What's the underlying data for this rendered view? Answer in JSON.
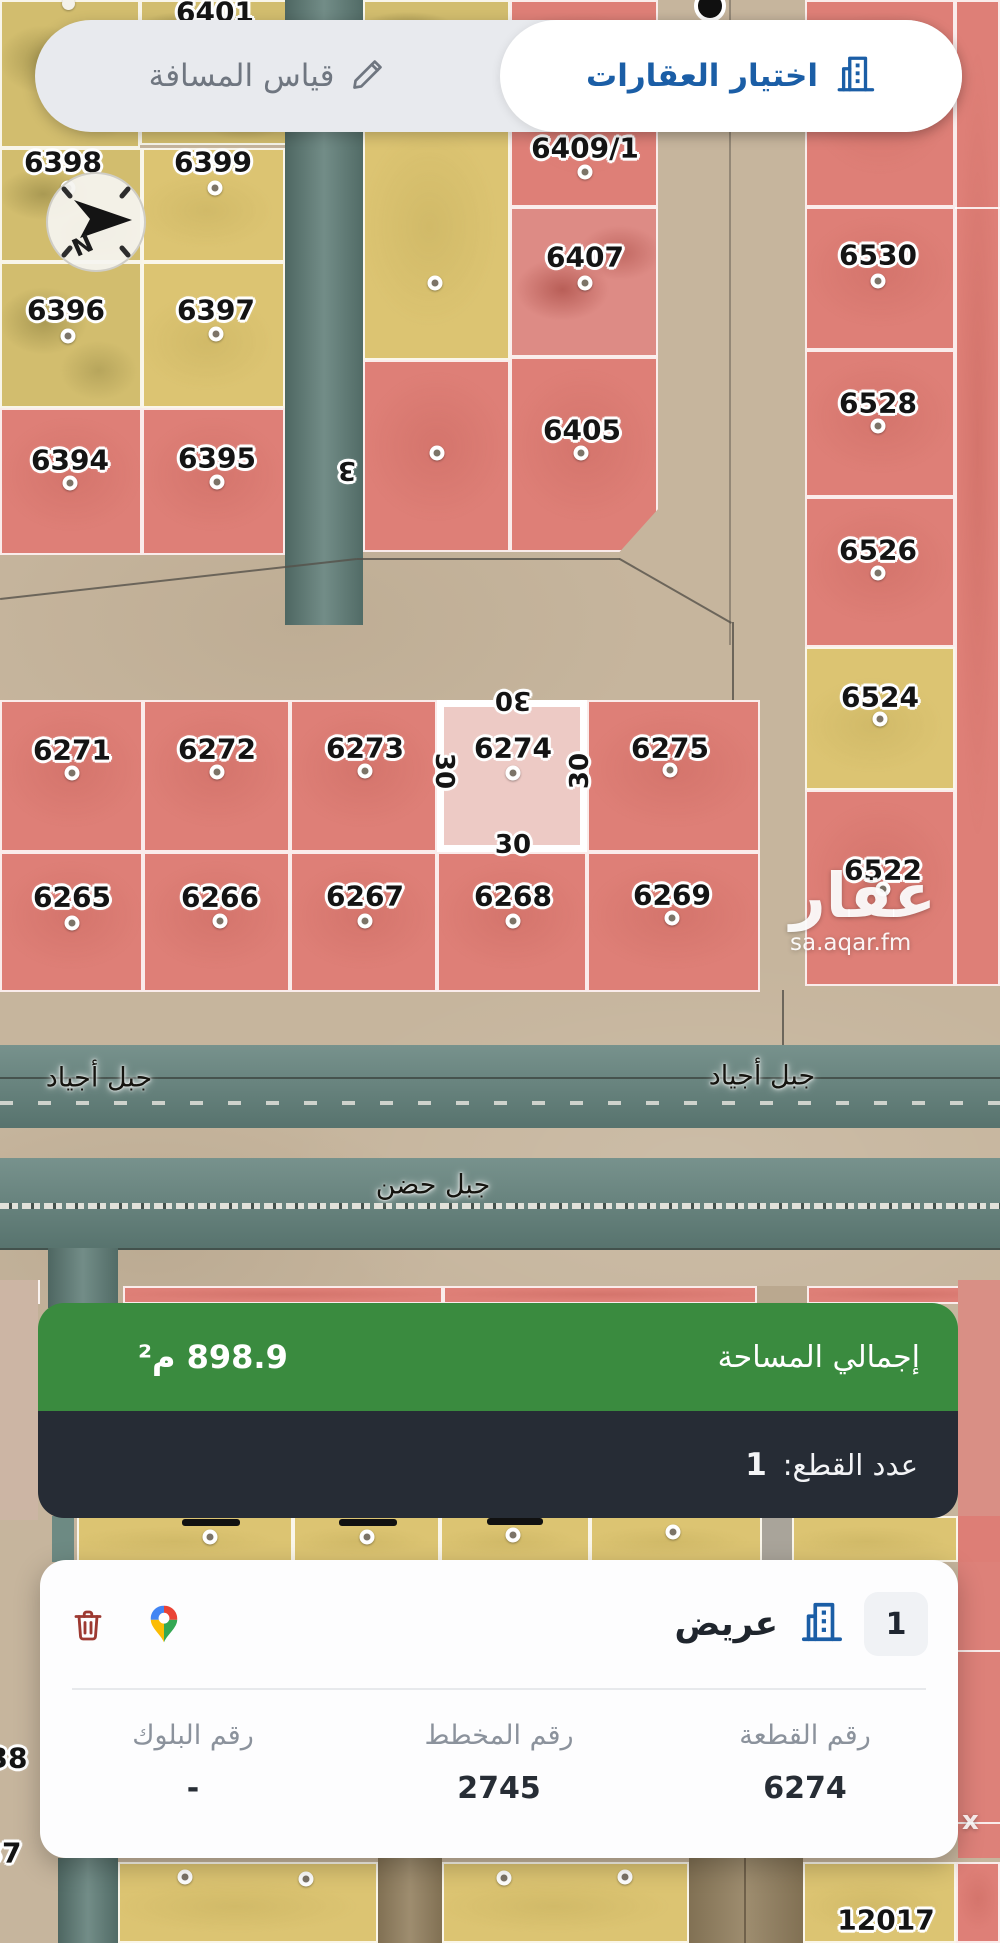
{
  "toolbar": {
    "measure_label": "قياس المسافة",
    "select_label": "اختيار العقارات"
  },
  "compass": {
    "letter": "N"
  },
  "map": {
    "parcels": [
      "6401",
      "6398",
      "6399",
      "6396",
      "6397",
      "6394",
      "6395",
      "6409/1",
      "6407",
      "6405",
      "6530",
      "6528",
      "6526",
      "6524",
      "6522",
      "6271",
      "6272",
      "6273",
      "6274",
      "6275",
      "6265",
      "6266",
      "6267",
      "6268",
      "6269",
      "12017"
    ],
    "selected": {
      "number": "6274",
      "dims": {
        "top": "30",
        "left": "30",
        "right": "30",
        "bottom": "30"
      }
    },
    "streets": [
      "جبل أجياد",
      "جبل أجياد",
      "جبل حضن"
    ],
    "road_marker": "3",
    "edge_labels": [
      "38",
      "37"
    ],
    "watermark": {
      "logo": "عقار",
      "domain": "sa.aqar.fm",
      "partial": "x"
    }
  },
  "summary": {
    "total_area_label": "إجمالي المساحة",
    "total_area_value": "898.9 م²",
    "count_label": "عدد القطع:",
    "count_value": "1"
  },
  "card": {
    "index": "1",
    "name": "عريض",
    "fields": [
      {
        "label": "رقم القطعة",
        "value": "6274"
      },
      {
        "label": "رقم المخطط",
        "value": "2745"
      },
      {
        "label": "رقم البلوك",
        "value": "-"
      }
    ]
  },
  "colors": {
    "accent_blue": "#1b5ea6",
    "panel_green": "#3a8b3f",
    "panel_dark": "#262c35",
    "parcel_red": "#de7f77",
    "parcel_yellow": "#dcc472",
    "selected_fill": "#edcac5",
    "trash_red": "#9d3931"
  }
}
